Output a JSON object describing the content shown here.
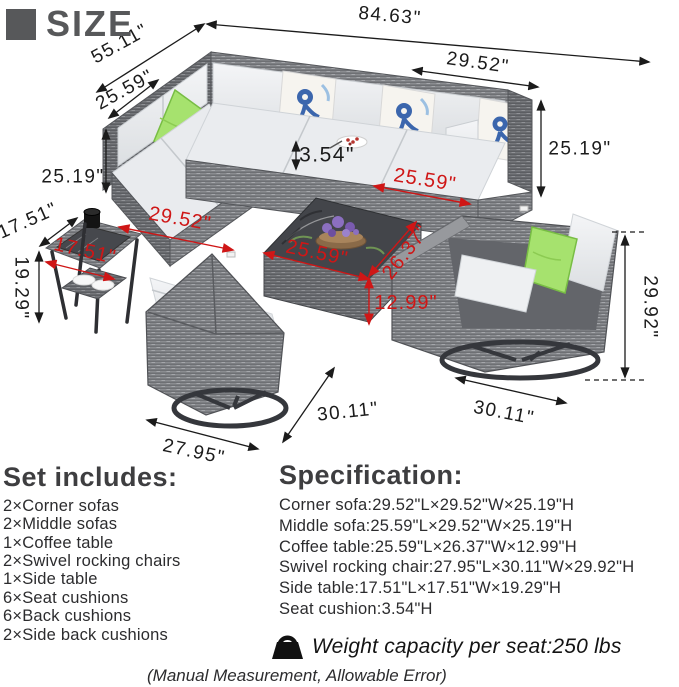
{
  "header": {
    "title": "SIZE"
  },
  "dims": {
    "overall_width": "84.63\"",
    "overall_depth": "55.11\"",
    "corner_depth_top": "25.59\"",
    "sofa_height_left": "25.19\"",
    "cushion_height": "3.54\"",
    "corner_width_top": "29.52\"",
    "sofa_height_right": "25.19\"",
    "side_table_width_black": "17.51\"",
    "side_table_height": "19.29\"",
    "chair_height": "29.92\"",
    "chair_width_right": "30.11\"",
    "chair_width_center": "30.11\"",
    "chair_depth": "27.95\"",
    "corner_width_red": "29.52\"",
    "middle_sofa_width_red": "25.59\"",
    "coffee_table_length_red": "25.59\"",
    "coffee_table_width_red": "26.37\"",
    "coffee_table_height_red": "12.99\"",
    "side_table_width_red": "17.51\""
  },
  "set_includes": {
    "title": "Set includes:",
    "items": [
      "2×Corner sofas",
      "2×Middle sofas",
      "1×Coffee table",
      "2×Swivel rocking chairs",
      "1×Side table",
      "6×Seat cushions",
      "6×Back cushions",
      "2×Side back cushions"
    ]
  },
  "specification": {
    "title": "Specification:",
    "items": [
      "Corner sofa:29.52\"L×29.52\"W×25.19\"H",
      "Middle sofa:25.59\"L×29.52\"W×25.19\"H",
      "Coffee table:25.59\"L×26.37\"W×12.99\"H",
      "Swivel rocking chair:27.95\"L×30.11\"W×29.92\"H",
      "Side table:17.51\"L×17.51\"W×19.29\"H",
      "Seat cushion:3.54\"H"
    ]
  },
  "weight": {
    "label": "Weight capacity per seat:250 lbs"
  },
  "footnote": "(Manual Measurement, Allowable Error)",
  "colors": {
    "dimension_black": "#1b1b1b",
    "dimension_red": "#cf1616",
    "heading_gray": "#57585a",
    "wicker_gray": "#898b8f",
    "cushion_white": "#edeff1",
    "pillow_green": "#a6e26e",
    "pillow_blue": "#3b66ad"
  }
}
